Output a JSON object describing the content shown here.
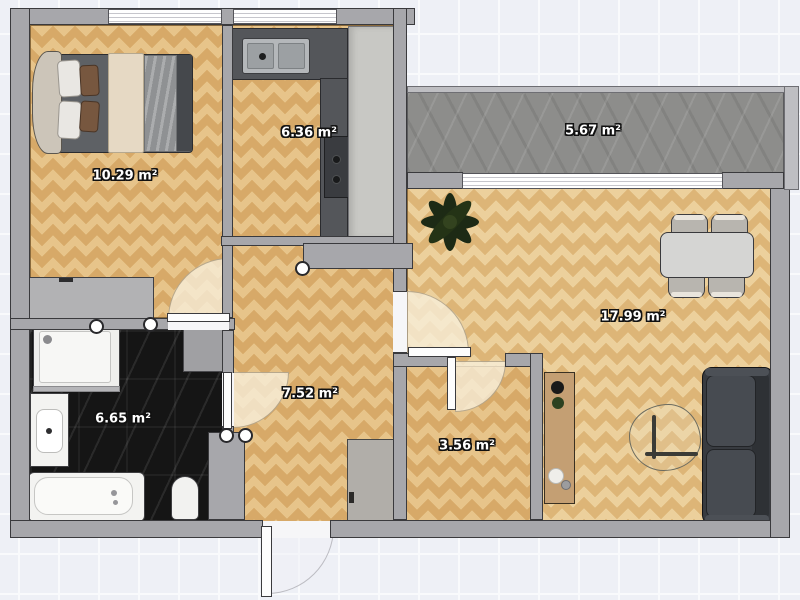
{
  "plan": {
    "grid_background": "#eef0f6",
    "wall_color": "#a7a7ab",
    "wood_floor_color": "#d7a968",
    "dark_tile_color": "#151515",
    "balcony_floor_color": "#8d8d8b",
    "door_arc_color": "#f7eeda",
    "sofa_color": "#3a3d42",
    "counter_color": "#54565a"
  },
  "rooms": {
    "bedroom": {
      "area_label": "10.29 m²"
    },
    "kitchen": {
      "area_label": "6.36 m²"
    },
    "balcony": {
      "area_label": "5.67 m²"
    },
    "living_room": {
      "area_label": "17.99 m²"
    },
    "hallway": {
      "area_label": "7.52 m²"
    },
    "bathroom": {
      "area_label": "6.65 m²"
    },
    "storage_room": {
      "area_label": "3.56 m²"
    }
  },
  "furniture": {
    "bedroom": [
      "double-bed",
      "wardrobe"
    ],
    "kitchen": [
      "sink-counter",
      "stove",
      "tall-cabinet"
    ],
    "bathroom": [
      "shower",
      "vanity-sink",
      "bathtub",
      "toilet",
      "cabinet"
    ],
    "living_room": [
      "plant",
      "dining-table",
      "chairs",
      "sofa",
      "coffee-table",
      "console"
    ],
    "hallway": [
      "cabinet"
    ]
  }
}
